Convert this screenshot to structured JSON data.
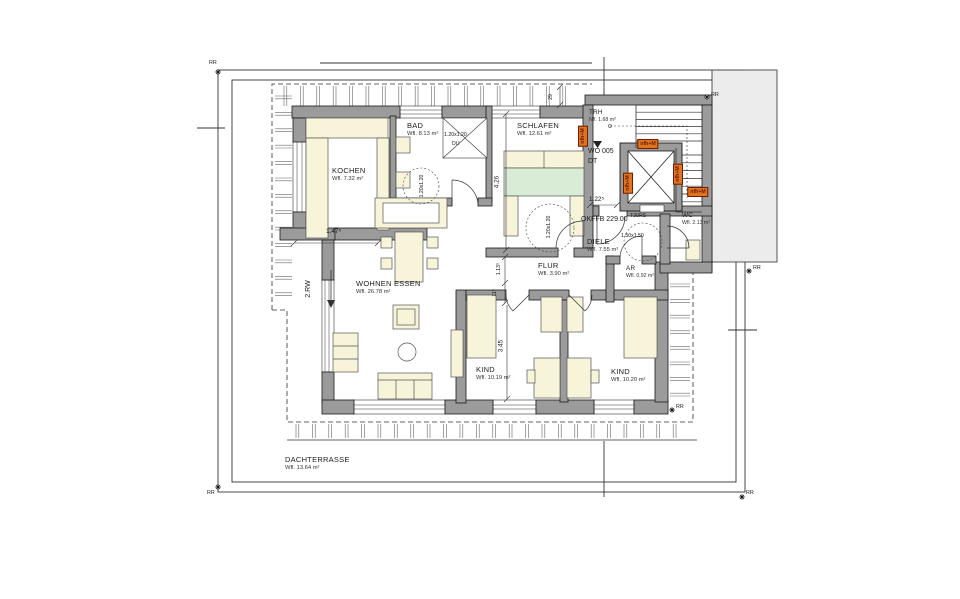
{
  "rooms": [
    {
      "id": "kochen",
      "name": "KOCHEN",
      "area": "Wfl. 7.32 m²"
    },
    {
      "id": "bad",
      "name": "BAD",
      "area": "Wfl. 8.13 m²"
    },
    {
      "id": "schlafen",
      "name": "SCHLAFEN",
      "area": "Wfl. 12.61 m²"
    },
    {
      "id": "trh",
      "name": "TRH",
      "area": "Nfl. 1.68 m²"
    },
    {
      "id": "wc",
      "name": "WC",
      "area": "Wfl. 2.13 m²"
    },
    {
      "id": "diele",
      "name": "DIELE",
      "area": "Wfl. 7.55 m²"
    },
    {
      "id": "ar",
      "name": "AR",
      "area": "Wfl. 0.92 m²"
    },
    {
      "id": "flur",
      "name": "FLUR",
      "area": "Wfl. 3.90 m²"
    },
    {
      "id": "wohnen",
      "name": "WOHNEN ESSEN",
      "area": "Wfl. 26.78 m²"
    },
    {
      "id": "kind1",
      "name": "KIND",
      "area": "Wfl. 10.19 m²"
    },
    {
      "id": "kind2",
      "name": "KIND",
      "area": "Wfl. 10.20 m²"
    },
    {
      "id": "dachterrasse",
      "name": "DACHTERRASSE",
      "area": "Wfl. 13.64 m²"
    }
  ],
  "annotations": {
    "unit": "WO 005",
    "unit_type": "DT",
    "floor_level": "OKFFB 229.00",
    "escape_route": "2.RW",
    "elevator_door": "T30RS",
    "shower": "DU"
  },
  "dimensions": [
    {
      "id": "kitchen_width",
      "text": "1.47⁵"
    },
    {
      "id": "schlafen_length",
      "text": "4.26"
    },
    {
      "id": "wall_29",
      "text": "29"
    },
    {
      "id": "entry_width",
      "text": "1.22⁵"
    },
    {
      "id": "flur_a",
      "text": "1.13⁵"
    },
    {
      "id": "flur_b",
      "text": "11⁵"
    },
    {
      "id": "kind_length",
      "text": "3.45"
    },
    {
      "id": "shower_size",
      "text": "1.20x1.20"
    },
    {
      "id": "bad_zone",
      "text": "1.20x1.20"
    },
    {
      "id": "schlafen_zone",
      "text": "1.20x1.20"
    },
    {
      "id": "diele_zone",
      "text": "1.50x1.50"
    }
  ],
  "door_tags": {
    "label": "nfh+M",
    "count": 5
  },
  "survey_markers": {
    "label": "RR",
    "count": 6
  },
  "colors": {
    "wall": "#9b9b9b",
    "furniture": "#f8f4da",
    "bed": "#d9ecd6",
    "neighbor": "#ececec",
    "tag_bg": "#e1741e",
    "tag_text": "#6e1a05",
    "line": "#1a1a1a"
  }
}
